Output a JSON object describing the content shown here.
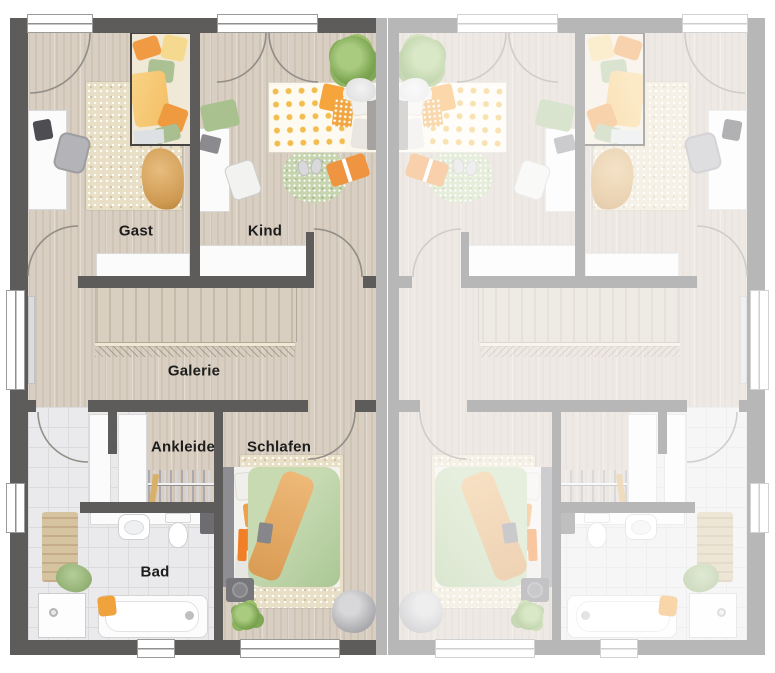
{
  "plan": {
    "type": "floor-plan-upper-storey-duplex",
    "units": [
      {
        "name": "left-unit",
        "state": "active"
      },
      {
        "name": "right-unit",
        "state": "faded-mirror-copy"
      }
    ],
    "rooms": {
      "gast": {
        "label": "Gast"
      },
      "kind": {
        "label": "Kind"
      },
      "galerie": {
        "label": "Galerie"
      },
      "ankleide": {
        "label": "Ankleide"
      },
      "schlafen": {
        "label": "Schlafen"
      },
      "bad": {
        "label": "Bad"
      }
    },
    "colors": {
      "wall": "#5e5b5b",
      "wall_faded": "#aaa8a8",
      "floor_wood": "#d8cec1",
      "floor_tile": "#eaeaec",
      "rug_beige": "#e9dfc6",
      "rug_green": "#c6d5ae",
      "accent_orange": "#ef9440",
      "accent_green": "#abc795",
      "accent_yellow": "#f6cf7d"
    }
  }
}
